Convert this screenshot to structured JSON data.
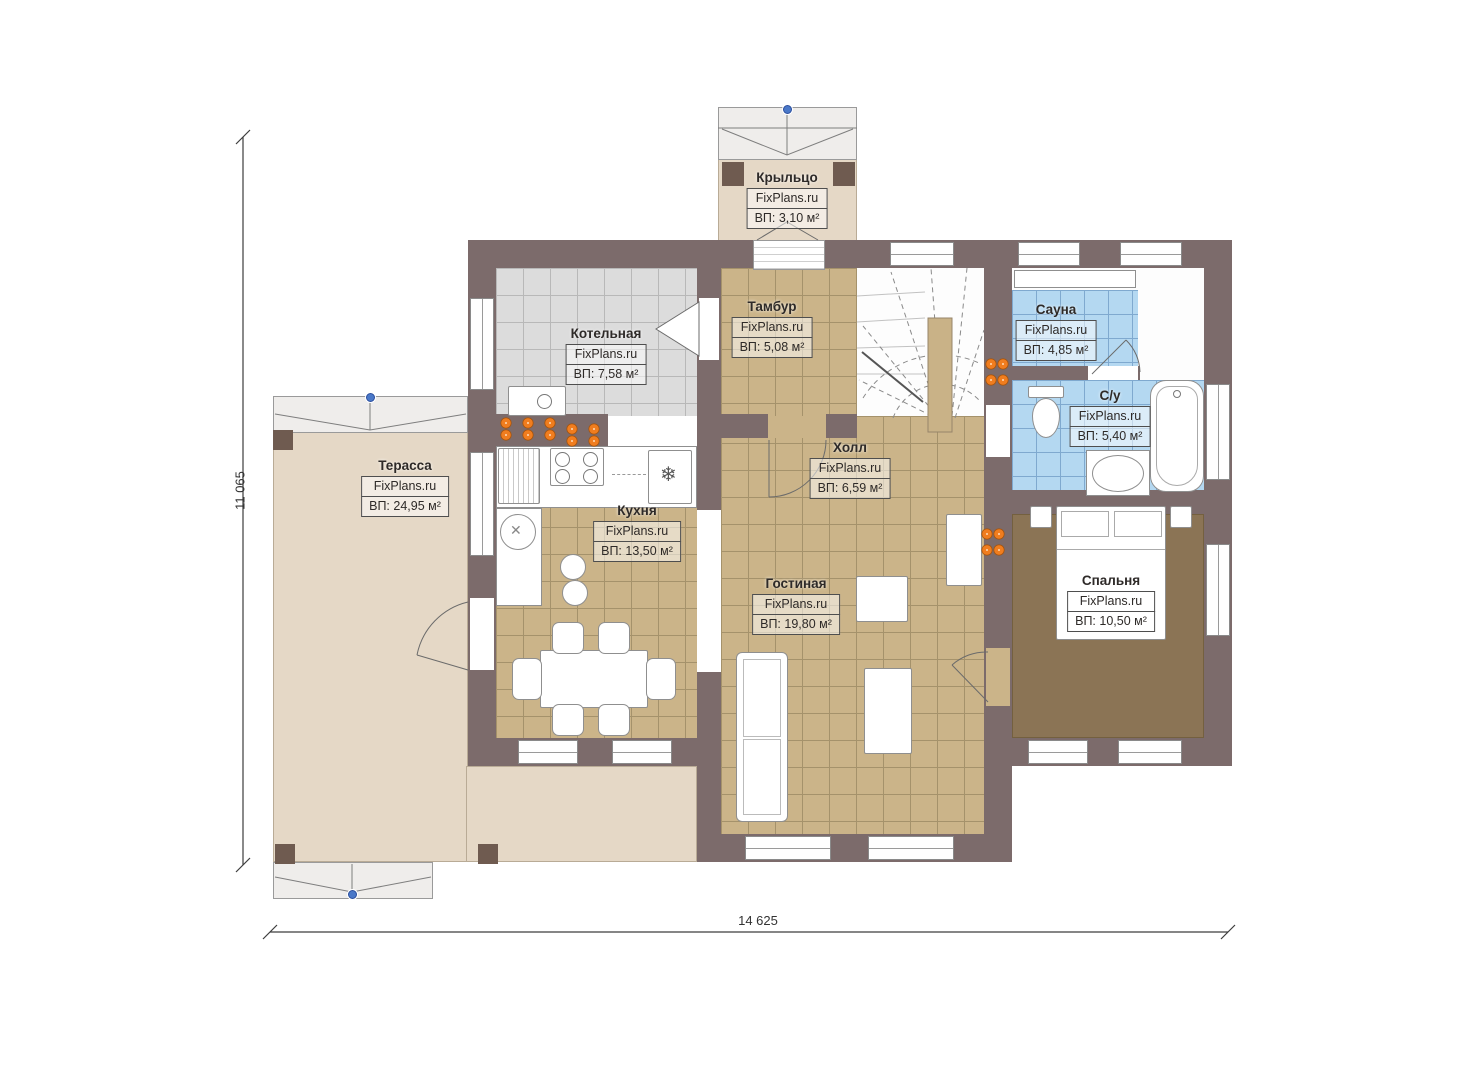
{
  "plan": {
    "brand": "FixPlans.ru",
    "dimensions": {
      "width": "14 625",
      "height": "11 065"
    },
    "rooms": [
      {
        "id": "porch",
        "name": "Крыльцо",
        "brand": "FixPlans.ru",
        "area": "ВП: 3,10 м²"
      },
      {
        "id": "boiler",
        "name": "Котельная",
        "brand": "FixPlans.ru",
        "area": "ВП: 7,58 м²"
      },
      {
        "id": "tambour",
        "name": "Тамбур",
        "brand": "FixPlans.ru",
        "area": "ВП: 5,08 м²"
      },
      {
        "id": "sauna",
        "name": "Сауна",
        "brand": "FixPlans.ru",
        "area": "ВП: 4,85 м²"
      },
      {
        "id": "wc",
        "name": "С/у",
        "brand": "FixPlans.ru",
        "area": "ВП: 5,40 м²"
      },
      {
        "id": "hall",
        "name": "Холл",
        "brand": "FixPlans.ru",
        "area": "ВП: 6,59 м²"
      },
      {
        "id": "terrace",
        "name": "Терасса",
        "brand": "FixPlans.ru",
        "area": "ВП: 24,95 м²"
      },
      {
        "id": "kitchen",
        "name": "Кухня",
        "brand": "FixPlans.ru",
        "area": "ВП: 13,50 м²"
      },
      {
        "id": "living",
        "name": "Гостиная",
        "brand": "FixPlans.ru",
        "area": "ВП: 19,80 м²"
      },
      {
        "id": "bedroom",
        "name": "Спальня",
        "brand": "FixPlans.ru",
        "area": "ВП: 10,50 м²"
      }
    ],
    "icons": {
      "fridge": "❄",
      "sink": "✕"
    },
    "colors": {
      "wall": "#7c6b6b",
      "floor_tan": "#cbb489",
      "floor_gray": "#dcdcdc",
      "floor_blue": "#b4d8f1",
      "terrace": "#e5d8c6",
      "carpet": "#8b7455",
      "radiator": "#f07d1f",
      "roof_marker": "#4a78c8"
    }
  }
}
